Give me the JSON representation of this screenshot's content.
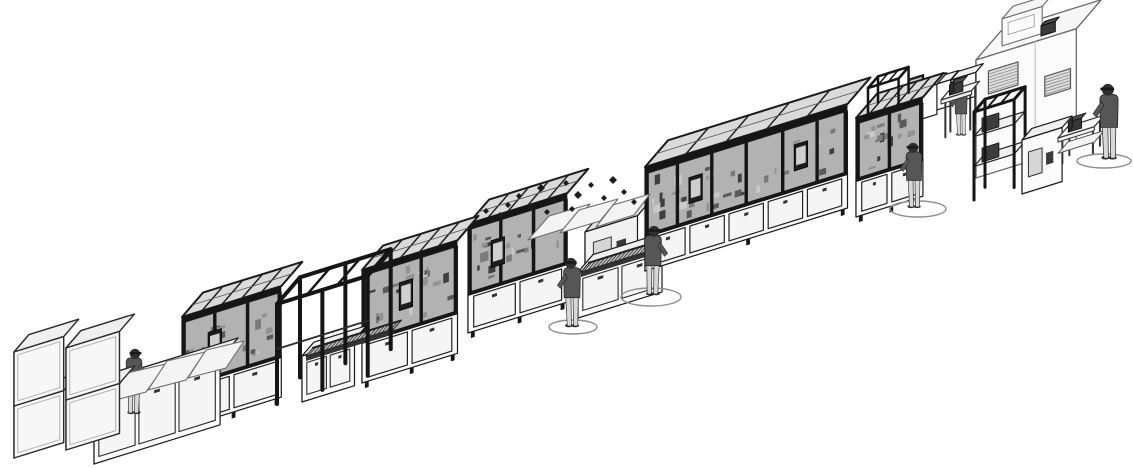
{
  "scene": {
    "canvas": {
      "w": 1133,
      "h": 468
    },
    "background": "#ffffff",
    "projection": {
      "a": [
        0.955,
        -0.297
      ],
      "b": [
        0.5,
        -0.58
      ]
    },
    "palette": {
      "ink": "#1b1b1b",
      "frame": "#151515",
      "softInk": "#6e6e6e",
      "white": "#fbfbfb",
      "light": "#f0f0f0",
      "mid": "#e3e3e3",
      "shade": "#cdcdcd",
      "glass": "#b2b2b2",
      "glassTop": "#dadada",
      "door": "#f5f5f5",
      "belt": "#c2c2c2",
      "beltTick": "#3c3c3c",
      "screen": "#1d1d1d",
      "screenFace": "#cfcfcf",
      "shirt": "#565656",
      "pants": "#d8d8d8",
      "skin": "#303030",
      "matStroke": "#8f8f8f",
      "debris": "#1c1c1c",
      "boothStroke": "#6a6a6a",
      "grille": "#8a8a8a"
    },
    "elements": [
      {
        "name": "test-booth",
        "kind": "booth",
        "x": 976,
        "y": 178,
        "len": 105,
        "dep": 50,
        "hgt": 118,
        "windows": [
          {
            "t0": 13,
            "t1": 44,
            "z0": 80,
            "z1": 103
          },
          {
            "t0": 72,
            "t1": 99,
            "z0": 60,
            "z1": 80
          }
        ],
        "roofUnit": {
          "t": 20,
          "len": 42,
          "dep": 22,
          "hgt": 27
        },
        "seam": 62
      },
      {
        "name": "roof-vent",
        "kind": "cuboid",
        "x": 1041,
        "y": 36,
        "len": 15,
        "dep": 8,
        "hgt": 10,
        "tone": "dark"
      },
      {
        "name": "bench-box-1",
        "kind": "cuboid",
        "x": 924,
        "y": 114,
        "len": 28,
        "dep": 16,
        "hgt": 26,
        "tone": "white"
      },
      {
        "name": "bench-box-2",
        "kind": "cuboid",
        "x": 951,
        "y": 104,
        "len": 26,
        "dep": 15,
        "hgt": 24,
        "tone": "white"
      },
      {
        "name": "operator-5",
        "kind": "person",
        "x": 961,
        "y": 134,
        "h": 50,
        "face": -1
      },
      {
        "name": "inspection-counter",
        "kind": "table",
        "x": 941,
        "y": 140,
        "len": 32,
        "dep": 16,
        "hgt": 40,
        "eq": true
      },
      {
        "name": "bench-station",
        "kind": "cuboid",
        "x": 893,
        "y": 128,
        "len": 46,
        "dep": 20,
        "hgt": 30,
        "tone": "white",
        "screenTop": 0.35
      },
      {
        "name": "equipment-rack",
        "kind": "openFrame",
        "x": 974,
        "y": 200,
        "len": 42,
        "dep": 22,
        "hgt": 88,
        "sw": 3,
        "shelves": [
          0.38,
          0.72
        ],
        "boxes": true
      },
      {
        "name": "booth-aux-machine",
        "kind": "cuboid",
        "x": 1022,
        "y": 194,
        "len": 42,
        "dep": 20,
        "hgt": 54,
        "tone": "white",
        "panel": true
      },
      {
        "name": "packing-table",
        "kind": "table",
        "x": 1058,
        "y": 166,
        "len": 38,
        "dep": 20,
        "hgt": 28,
        "shelf": true,
        "eq": true
      },
      {
        "name": "floor-mat-6",
        "kind": "mat",
        "cx": 1104,
        "cy": 161,
        "rx": 27,
        "ry": 7
      },
      {
        "name": "operator-6",
        "kind": "person",
        "x": 1109,
        "y": 157,
        "h": 74,
        "face": -1
      },
      {
        "name": "final-test-machine",
        "kind": "enclosure",
        "x": 856,
        "y": 222,
        "len": 70,
        "dep": 42,
        "baseH": 42,
        "glassH": 56,
        "roofH": 6,
        "mullions": [
          0.5
        ],
        "doors": 2,
        "monitors": [],
        "specks": 16
      },
      {
        "name": "mast-frame",
        "kind": "openFrame",
        "x": 868,
        "y": 114,
        "len": 32,
        "dep": 20,
        "hgt": 26,
        "sw": 2.5
      },
      {
        "name": "floor-mat-5",
        "kind": "mat",
        "cx": 918,
        "cy": 209,
        "rx": 28,
        "ry": 8
      },
      {
        "name": "operator-4",
        "kind": "person",
        "x": 914,
        "y": 206,
        "h": 64,
        "face": -1
      },
      {
        "name": "screw-feeder-unit",
        "kind": "cuboid",
        "x": 585,
        "y": 282,
        "len": 55,
        "dep": 34,
        "hgt": 50,
        "tone": "light",
        "panel": true
      },
      {
        "name": "transfer-conveyor",
        "kind": "cuboid",
        "x": 578,
        "y": 318,
        "len": 88,
        "dep": 30,
        "hgt": 46,
        "tone": "white",
        "doors": 2
      },
      {
        "name": "transfer-belt",
        "kind": "belt",
        "x": 581,
        "y": 272,
        "len": 84,
        "dep": 16
      },
      {
        "name": "assembly-enclosure-4",
        "kind": "enclosure",
        "x": 645,
        "y": 276,
        "len": 212,
        "dep": 46,
        "baseH": 40,
        "glassH": 62,
        "roofH": 7,
        "mullions": [
          0.16,
          0.33,
          0.5,
          0.68,
          0.85
        ],
        "doors": 5,
        "monitors": [
          0.25,
          0.77
        ],
        "specks": 34
      },
      {
        "name": "floor-mat-4",
        "kind": "mat",
        "cx": 651,
        "cy": 297,
        "rx": 30,
        "ry": 9
      },
      {
        "name": "operator-3",
        "kind": "person",
        "x": 653,
        "y": 293,
        "h": 68,
        "face": 1
      },
      {
        "name": "assembly-enclosure-3",
        "kind": "enclosure",
        "x": 468,
        "y": 338,
        "len": 104,
        "dep": 42,
        "baseH": 44,
        "glassH": 64,
        "roofH": 6,
        "mullions": [
          0.33,
          0.66
        ],
        "doors": 2,
        "monitors": [
          0.3
        ],
        "specks": 20
      },
      {
        "name": "ejected-cover-panels",
        "kind": "panels",
        "quads": [
          [
            [
              528,
              240
            ],
            [
              570,
              227
            ],
            [
              590,
              204
            ],
            [
              549,
              216
            ]
          ],
          [
            [
              560,
              233
            ],
            [
              600,
              221
            ],
            [
              618,
              199
            ],
            [
              579,
              210
            ]
          ],
          [
            [
              596,
              227
            ],
            [
              634,
              215
            ],
            [
              650,
              194
            ],
            [
              613,
              205
            ]
          ]
        ]
      },
      {
        "name": "fastener-debris",
        "kind": "debris",
        "points": [
          [
            486,
            211,
            3
          ],
          [
            500,
            215,
            3
          ],
          [
            508,
            205,
            3
          ],
          [
            519,
            196,
            3
          ],
          [
            531,
            208,
            3
          ],
          [
            541,
            188,
            4
          ],
          [
            554,
            200,
            3
          ],
          [
            566,
            183,
            3
          ],
          [
            578,
            195,
            4
          ],
          [
            591,
            185,
            3
          ],
          [
            604,
            198,
            3
          ],
          [
            613,
            180,
            4
          ],
          [
            624,
            192,
            3
          ],
          [
            634,
            202,
            3
          ],
          [
            547,
            212,
            3
          ],
          [
            572,
            209,
            3
          ]
        ]
      },
      {
        "name": "floor-mat-3",
        "kind": "mat",
        "cx": 573,
        "cy": 327,
        "rx": 24,
        "ry": 7
      },
      {
        "name": "operator-2",
        "kind": "person",
        "x": 572,
        "y": 325,
        "h": 68,
        "face": -1
      },
      {
        "name": "assembly-enclosure-2",
        "kind": "enclosure",
        "x": 362,
        "y": 388,
        "len": 100,
        "dep": 42,
        "baseH": 46,
        "glassH": 66,
        "roofH": 6,
        "mullions": [
          0.3,
          0.62
        ],
        "doors": 2,
        "monitors": [
          0.46
        ],
        "specks": 20
      },
      {
        "name": "link-cabinet",
        "kind": "cuboid",
        "x": 302,
        "y": 402,
        "len": 55,
        "dep": 24,
        "hgt": 46,
        "tone": "white",
        "doors": 2
      },
      {
        "name": "link-belt",
        "kind": "belt",
        "x": 306,
        "y": 356,
        "len": 92,
        "dep": 14
      },
      {
        "name": "assembly-enclosure-1",
        "kind": "enclosure",
        "x": 182,
        "y": 433,
        "len": 104,
        "dep": 42,
        "baseH": 46,
        "glassH": 64,
        "roofH": 6,
        "mullions": [
          0.33,
          0.66
        ],
        "doors": 2,
        "monitors": [
          0.33
        ],
        "specks": 20
      },
      {
        "name": "safety-frame",
        "kind": "openFrame",
        "x": 277,
        "y": 404,
        "len": 95,
        "dep": 46,
        "hgt": 100,
        "sw": 4,
        "midPosts": [
          0.5
        ],
        "rail": 0.55
      },
      {
        "name": "infeed-conveyor",
        "kind": "cuboid",
        "x": 94,
        "y": 464,
        "len": 132,
        "dep": 36,
        "hgt": 66,
        "tone": "white",
        "doors": 3
      },
      {
        "name": "operator-1",
        "kind": "person",
        "x": 134,
        "y": 412,
        "h": 64,
        "face": 1
      },
      {
        "name": "infeed-belt",
        "kind": "belt",
        "x": 97,
        "y": 398,
        "len": 128,
        "dep": 16
      },
      {
        "name": "cover-guards",
        "kind": "panels",
        "quads": [
          [
            [
              108,
              402
            ],
            [
              146,
              392
            ],
            [
              166,
              364
            ],
            [
              127,
              373
            ]
          ],
          [
            [
              148,
              390
            ],
            [
              186,
              380
            ],
            [
              205,
              352
            ],
            [
              167,
              361
            ]
          ],
          [
            [
              188,
              378
            ],
            [
              226,
              368
            ],
            [
              244,
              341
            ],
            [
              206,
              350
            ]
          ]
        ]
      },
      {
        "name": "crate-1",
        "kind": "cuboid",
        "x": 14,
        "y": 458,
        "len": 52,
        "dep": 30,
        "hgt": 52,
        "tone": "crate"
      },
      {
        "name": "crate-2",
        "kind": "cuboid",
        "x": 14,
        "y": 406,
        "len": 52,
        "dep": 30,
        "hgt": 54,
        "tone": "crate"
      },
      {
        "name": "crate-3",
        "kind": "cuboid",
        "x": 66,
        "y": 450,
        "len": 56,
        "dep": 30,
        "hgt": 50,
        "tone": "crate"
      },
      {
        "name": "crate-4",
        "kind": "cuboid",
        "x": 66,
        "y": 400,
        "len": 56,
        "dep": 30,
        "hgt": 52,
        "tone": "crate"
      }
    ]
  }
}
